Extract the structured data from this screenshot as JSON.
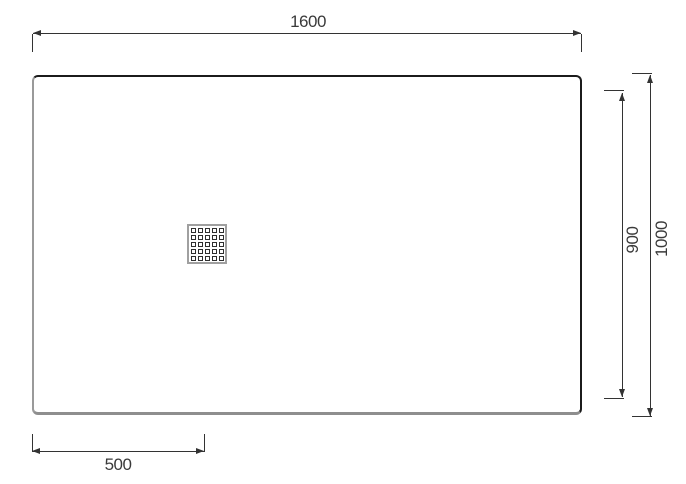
{
  "dimensions": {
    "width": {
      "label": "1600"
    },
    "height": {
      "label": "1000"
    },
    "inner_height": {
      "label": "900"
    },
    "drain_offset": {
      "label": "500"
    }
  },
  "drain": {
    "icon": "drain-grate-icon",
    "rows": 5,
    "cols": 5,
    "dot_size_px": 5,
    "gap_px": 2
  },
  "colors": {
    "line": "#333333",
    "text": "#3a3a3a",
    "edge_dark": "#1b1b1b",
    "edge_shadow": "#8e8e8e",
    "edge_light": "#9a9a9a",
    "drain_border": "#a0a0a0",
    "drain_dot": "#2f2f2f",
    "background": "#ffffff"
  }
}
